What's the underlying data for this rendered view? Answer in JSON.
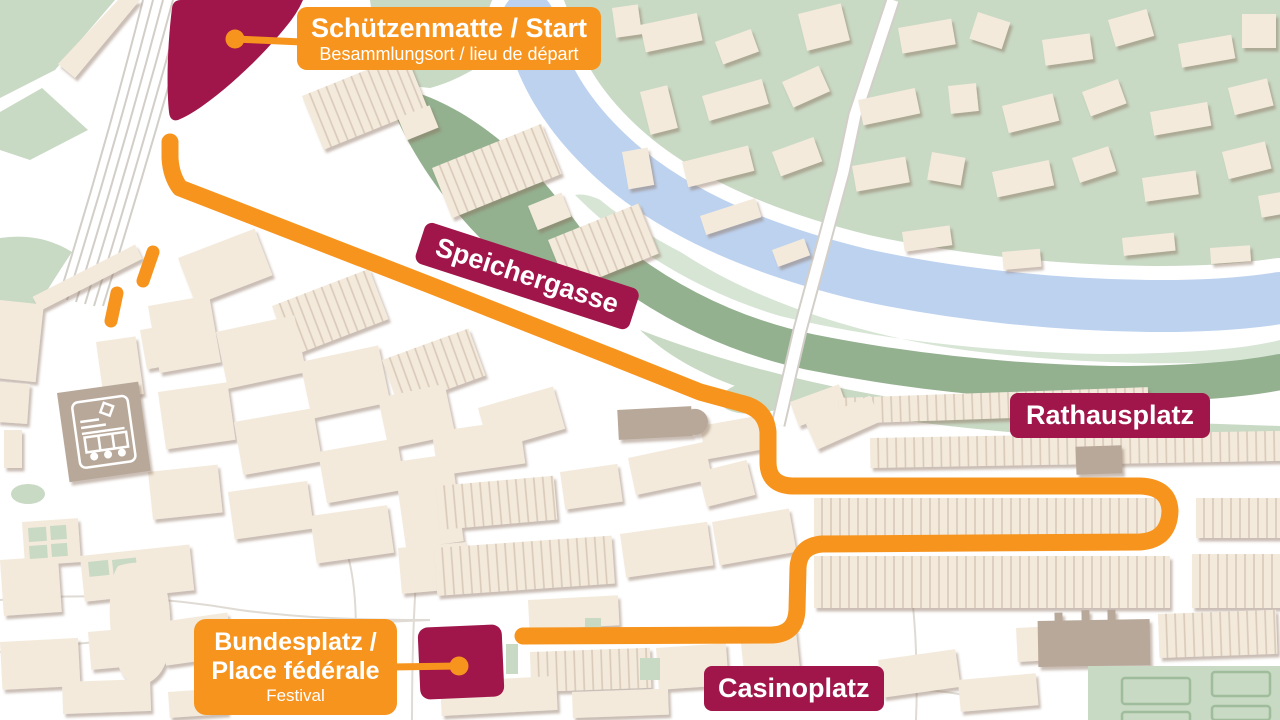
{
  "labels": {
    "start": {
      "title": "Schützenmatte / Start",
      "subtitle": "Besammlungsort / lieu de départ"
    },
    "speichergasse": "Speichergasse",
    "rathausplatz": "Rathausplatz",
    "bundesplatz": {
      "line1": "Bundesplatz /",
      "line2": "Place fédérale",
      "subtitle": "Festival"
    },
    "casinoplatz": "Casinoplatz"
  },
  "icons": {
    "station": "train-icon"
  },
  "colors": {
    "route_orange": "#F7941D",
    "label_magenta": "#A0164A",
    "river_blue": "#BDD2EF",
    "park_sage": "#C8D9C4",
    "park_pale": "#D3E2D0",
    "slope_dark": "#93B08F",
    "building_cream": "#F3EADC",
    "landmark_taupe": "#B8A899",
    "hatch_line": "#D9C9B9",
    "rail_gray": "#D2CEC8",
    "street_gray": "#DFDBD4",
    "map_white": "#FFFFFF",
    "text_white": "#FFFFFF"
  }
}
